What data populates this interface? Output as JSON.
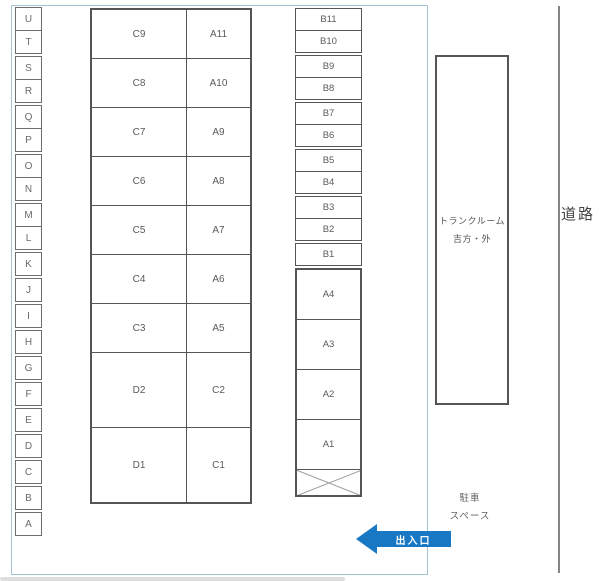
{
  "legend_column": {
    "letters": [
      "U",
      "T",
      "S",
      "R",
      "Q",
      "P",
      "O",
      "N",
      "M",
      "L",
      "K",
      "J",
      "I",
      "H",
      "G",
      "F",
      "E",
      "D",
      "C",
      "B",
      "A"
    ]
  },
  "main_block": {
    "rows": [
      {
        "left": "C9",
        "right": "A11"
      },
      {
        "left": "C8",
        "right": "A10"
      },
      {
        "left": "C7",
        "right": "A9"
      },
      {
        "left": "C6",
        "right": "A8"
      },
      {
        "left": "C5",
        "right": "A7"
      },
      {
        "left": "C4",
        "right": "A6"
      },
      {
        "left": "C3",
        "right": "A5"
      },
      {
        "left": "D2",
        "right": "C2"
      },
      {
        "left": "D1",
        "right": "C1"
      }
    ]
  },
  "b_block": {
    "b_cells": [
      "B11",
      "B10",
      "B9",
      "B8",
      "B7",
      "B6",
      "B5",
      "B4",
      "B3",
      "B2"
    ],
    "b1": "B1",
    "a_cells": [
      "A4",
      "A3",
      "A2",
      "A1"
    ]
  },
  "trunk_room": {
    "line1": "トランクルーム",
    "line2": "吉方・外"
  },
  "road": {
    "label": "道路"
  },
  "parking_space": {
    "line1": "駐車",
    "line2": "スペース"
  },
  "entrance": {
    "label": "出入口"
  },
  "colors": {
    "arrow_blue": "#1878c4",
    "boundary_blue": "#a3c3d3",
    "cell_border_gray": "#555555"
  }
}
